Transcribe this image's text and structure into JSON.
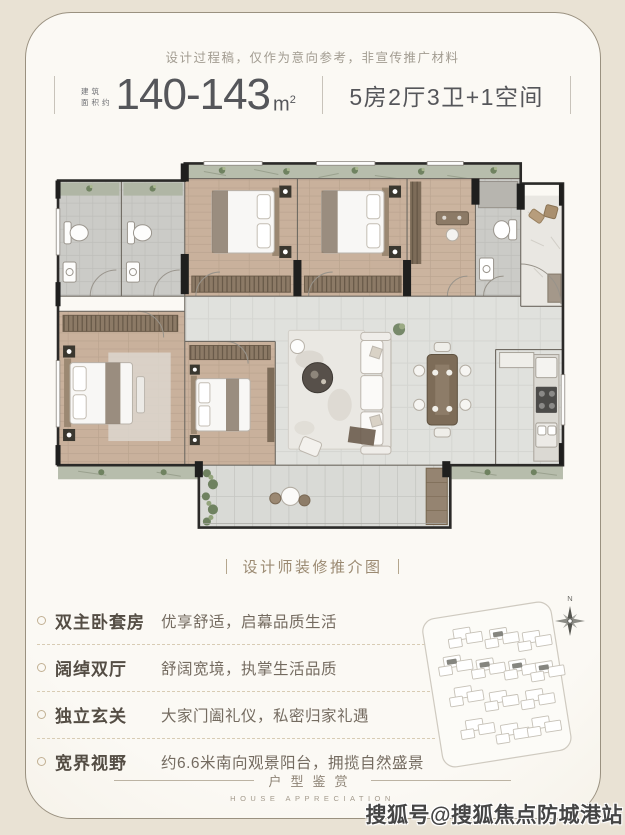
{
  "header": {
    "disclaimer": "设计过程稿，仅作为意向参考，非宣传推广材料",
    "area_prefix_line1": "建筑",
    "area_prefix_line2": "面积约",
    "area_value": "140-143",
    "area_unit_base": "m",
    "area_unit_sup": "2",
    "spec": "5房2厅3卫+1空间"
  },
  "plan_caption": {
    "text": "设计师装修推介图"
  },
  "features": [
    {
      "label": "双主卧套房",
      "desc": "优享舒适，启幕品质生活"
    },
    {
      "label": "阔绰双厅",
      "desc": "舒阔宽境，执掌生活品质"
    },
    {
      "label": "独立玄关",
      "desc": "大家门阖礼仪，私密归家礼遇"
    },
    {
      "label": "宽界视野",
      "desc": "约6.6米南向观景阳台，拥揽自然盛景"
    }
  ],
  "sitemap": {
    "compass_label": "N"
  },
  "footer": {
    "title": "户型鉴赏",
    "subtitle": "HOUSE APPRECIATION"
  },
  "watermark": "搜狐号@搜狐焦点防城港站",
  "colors": {
    "page_outer": "#e9e2d4",
    "card_bg": "#fbf9f4",
    "frame_border": "#9a9180",
    "title_text": "#55565a",
    "disclaimer_text": "#a29c91",
    "caption_text": "#9b8a72",
    "feature_label": "#544d44",
    "feature_desc": "#746b60",
    "dashed_line": "#d8ccb4",
    "footer_text": "#8d8375",
    "watermark_text": "#454545",
    "plan_wood": "#c9b19c",
    "plan_tile": "#e0e1dd",
    "plan_wall": "#1f1f1e"
  },
  "icons": {
    "compass": "compass-rose-8-point",
    "bullet": "small-ring-circle"
  }
}
